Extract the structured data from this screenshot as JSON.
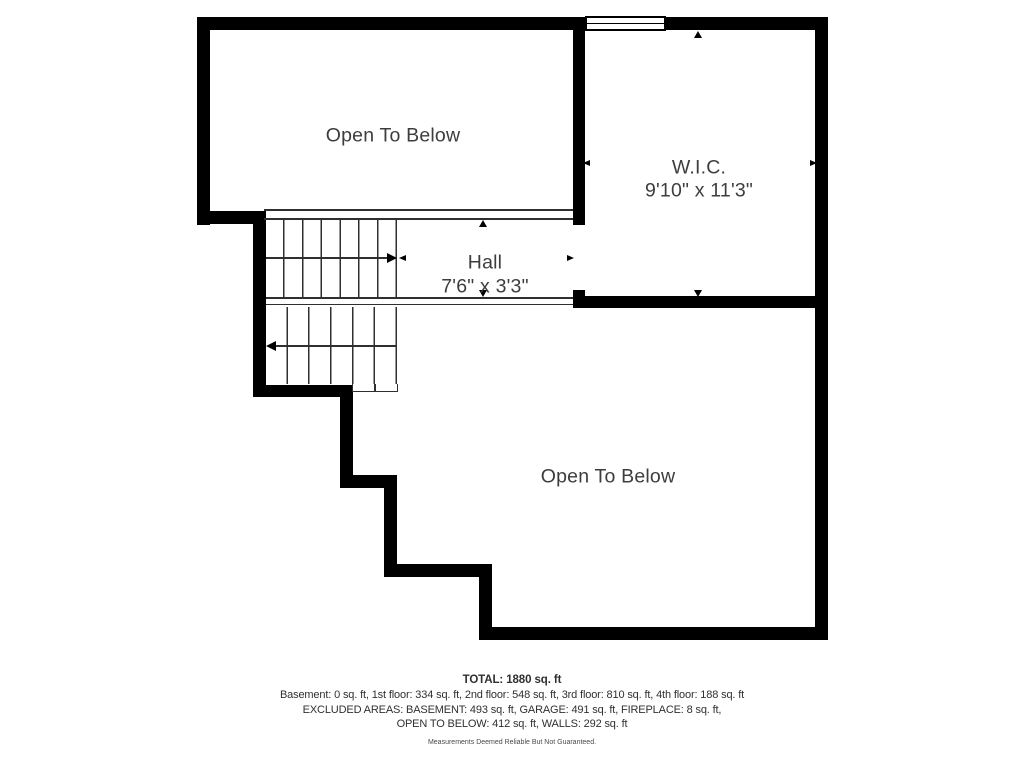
{
  "floor_plan": {
    "rooms": {
      "open_to_below_upper": {
        "label": "Open To Below"
      },
      "wic": {
        "label": "W.I.C.",
        "dimensions": "9'10\" x 11'3\""
      },
      "hall": {
        "label": "Hall",
        "dimensions": "7'6\" x 3'3\""
      },
      "open_to_below_lower": {
        "label": "Open To Below"
      }
    },
    "icons": {
      "stairs_up_arrow": "right-arrow",
      "stairs_down_arrow": "left-arrow",
      "dimension_arrows": "small-triangle-arrowheads",
      "window": "double-pane-window"
    }
  },
  "summary": {
    "total": "TOTAL: 1880 sq. ft",
    "floor_breakdown": "Basement: 0 sq. ft, 1st floor: 334 sq. ft, 2nd floor: 548 sq. ft, 3rd floor: 810 sq. ft, 4th floor: 188 sq. ft",
    "excluded_line1": "EXCLUDED AREAS: BASEMENT: 493 sq. ft, GARAGE: 491 sq. ft, FIREPLACE: 8 sq. ft,",
    "excluded_line2": "OPEN TO BELOW: 412 sq. ft, WALLS: 292 sq. ft",
    "disclaimer": "Measurements Deemed Reliable But Not Guaranteed."
  },
  "colors": {
    "wall": "#000000",
    "thin_line": "#2f2f2f",
    "label_text": "#3d3d3d",
    "summary_text": "#303030",
    "background": "#ffffff"
  }
}
